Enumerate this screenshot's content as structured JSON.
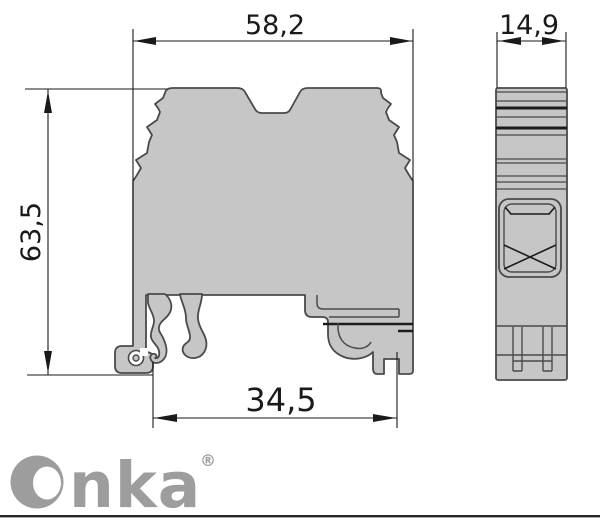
{
  "drawing": {
    "front_view": {
      "width_top": "58,2",
      "height": "63,5",
      "width_bottom": "34,5"
    },
    "side_view": {
      "width": "14,9"
    }
  },
  "branding": {
    "logo_text": "Onka",
    "logo_tail": "nka",
    "trademark": "®"
  },
  "colors": {
    "background": "#ffffff",
    "body_fill": "#c6c6c6",
    "outline": "#4a4a4a",
    "dimension_line": "#1a1a1a",
    "logo_gray": "#9d9d9d",
    "bottom_rule": "#262626"
  }
}
